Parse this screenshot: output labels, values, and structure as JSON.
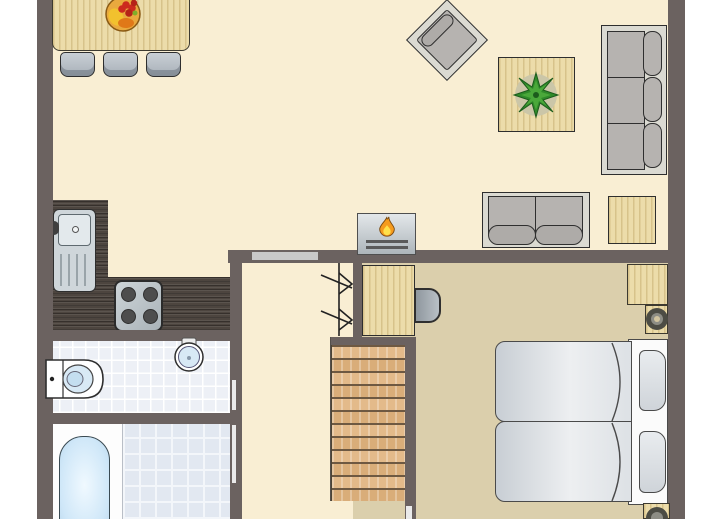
{
  "meta": {
    "type": "floor-plan",
    "view": "top-down",
    "text_visible": "none"
  },
  "palette": {
    "page_bg": "#ffffff",
    "wall": "#6b6260",
    "floor_living": "#f9eed3",
    "floor_bedroom": "#dbcfac",
    "wood_light": "#ecdcaa",
    "counter_dark": "#4d453f",
    "stair_wood_a": "#e3ba8a",
    "stair_wood_b": "#d9ad79",
    "tile_white_room": "#edf0f6",
    "tile_blue_room": "#e2e8f1",
    "fabric_gray": "#b6b3b0",
    "frame_gray": "#dbdad2",
    "water_blue": "#d8e9f5",
    "tub_blue": "#cfe7f8",
    "bed_white": "#fbfbfb",
    "outline": "#2e2e2e",
    "flame_orange": "#f59b1e",
    "flame_yellow": "#ffe14a",
    "plant_green": "#2f8a2a",
    "door_gray": "#c9c9c9",
    "fruit_bowl": "#e9a93e"
  },
  "rooms": {
    "living_room": {
      "furniture": [
        "dining-table",
        "dining-chairs",
        "fruit-bowl",
        "armchair",
        "coffee-table",
        "plant",
        "sofa-3-seat",
        "loveseat",
        "side-table",
        "fireplace"
      ]
    },
    "kitchen": {
      "furniture": [
        "l-shaped-counter",
        "sink",
        "stove"
      ]
    },
    "toilet_room": {
      "furniture": [
        "toilet",
        "wall-basin"
      ]
    },
    "bathroom": {
      "furniture": [
        "bathtub",
        "tiled-floor"
      ]
    },
    "hall": {
      "furniture": [
        "staircase",
        "stair-direction-marks",
        "door-opening"
      ]
    },
    "bedroom": {
      "furniture": [
        "desk",
        "desk-chair",
        "twin-beds",
        "pillows",
        "corner-cabinet",
        "bedside-units"
      ]
    }
  },
  "counts": {
    "dining_chairs": 3,
    "sofa_back_cushions": 3,
    "loveseat_seats": 2,
    "beds": 2,
    "stove_burners": 4,
    "stair_treads": 12
  }
}
